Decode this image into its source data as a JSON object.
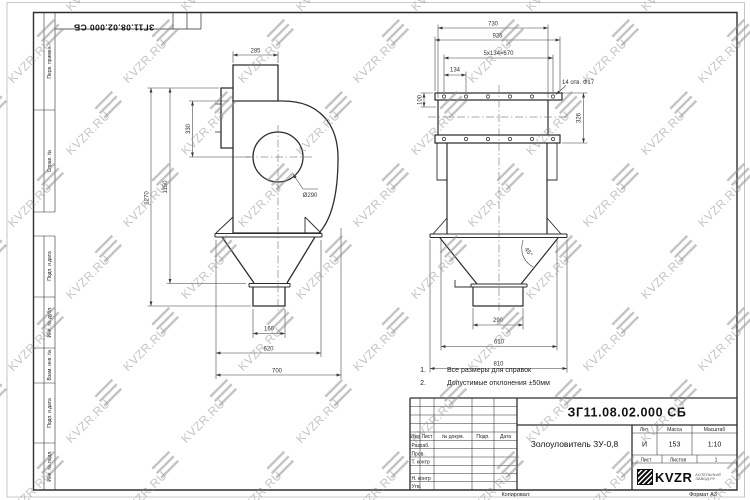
{
  "watermark": {
    "text": "KVZR.RU"
  },
  "frame": {
    "corner_stamp": "ЗГ11.08.02.000 СБ",
    "margin_labels": [
      "Перв. примен.",
      "Справ. №",
      "Подп. и дата",
      "Инв. № дубл.",
      "Взам. инв. №",
      "Подп. и дата",
      "Инв. № подл."
    ],
    "footer": {
      "copied": "Копировал:",
      "format": "Формат А3"
    }
  },
  "views": {
    "front": {
      "dims": {
        "inlet_width": "285",
        "inlet_to_center": "330",
        "height_to_cone": "1150",
        "overall_height": "1270",
        "body_dia": "Ø290",
        "outlet_width": "160",
        "hopper_width": "620",
        "overall_depth": "700"
      }
    },
    "side": {
      "dims": {
        "duct_width": "730",
        "flange_width": "926",
        "bolt_pitch": "5x134=670",
        "first_pitch": "134",
        "holes_note": "14 отв. Ф17",
        "flange_offset": "100",
        "flange_height": "326",
        "cone_angle": "45°",
        "outlet_width": "290",
        "cone_top_width": "610",
        "hopper_width": "810"
      }
    }
  },
  "notes": [
    {
      "num": "1.",
      "text": "Все размеры для справок"
    },
    {
      "num": "2.",
      "text": "Допустимые отклонения ±50мм"
    }
  ],
  "title_block": {
    "doc_number": "ЗГ11.08.02.000 СБ",
    "product_title": "Золоуловитель ЗУ-0,8",
    "col_headers": {
      "lit": "Лит.",
      "mass": "Масса",
      "scale": "Масштаб"
    },
    "col_values": {
      "lit": "И",
      "mass": "153",
      "scale": "1:10"
    },
    "sheet_label": "Лист",
    "sheets_label": "Листов",
    "sheets_value": "1",
    "table_headers": [
      "Изм",
      "Лист",
      "№ докум.",
      "Подп.",
      "Дата"
    ],
    "row_labels": [
      "Разраб.",
      "Пров.",
      "Т. контр",
      "Н. контр",
      "Утв."
    ],
    "logo": {
      "name": "KVZR",
      "tagline_line1": "КОТЕЛЬНЫЙ",
      "tagline_line2": "ЗАВОД.РУ"
    }
  }
}
